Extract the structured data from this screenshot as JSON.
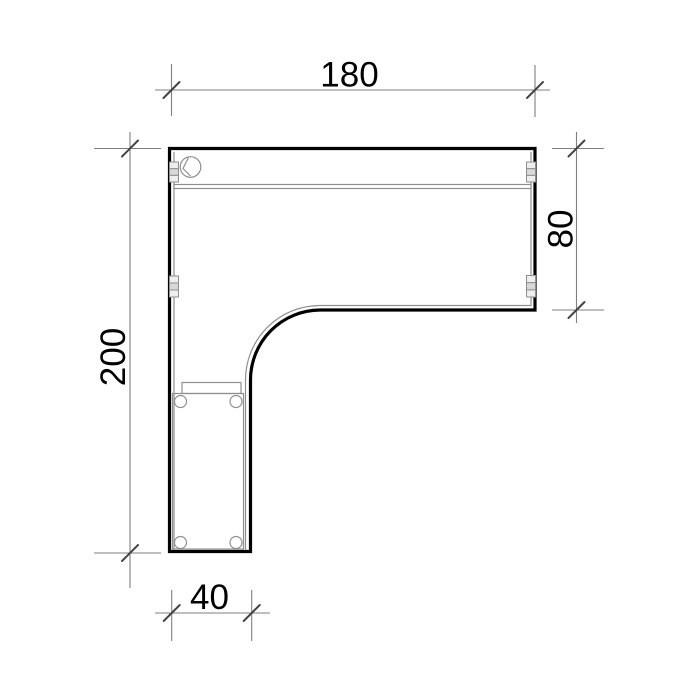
{
  "drawing": {
    "kind": "furniture-plan-technical-drawing",
    "dimensions": {
      "top": {
        "label": "180",
        "value": 180,
        "orientation": "horizontal"
      },
      "right": {
        "label": "80",
        "value": 80,
        "orientation": "vertical"
      },
      "left": {
        "label": "200",
        "value": 200,
        "orientation": "vertical"
      },
      "bottom": {
        "label": "40",
        "value": 40,
        "orientation": "horizontal"
      }
    },
    "features": [
      {
        "name": "cable-grommet",
        "shape": "circle-with-slot"
      },
      {
        "name": "cable-duct",
        "shape": "double-line"
      },
      {
        "name": "panel-connector",
        "count": 4,
        "shape": "three-stacked-cells"
      },
      {
        "name": "pedestal",
        "shape": "rectangle"
      },
      {
        "name": "caster",
        "count": 4,
        "shape": "circle"
      },
      {
        "name": "drawer-handle",
        "shape": "rectangle"
      }
    ],
    "colors": {
      "background": "#ffffff",
      "outline": "#000000",
      "detail_line": "#8f8f8f",
      "dimension_line": "#7f7f7f",
      "tick": "#444444",
      "label_text": "#000000"
    }
  }
}
